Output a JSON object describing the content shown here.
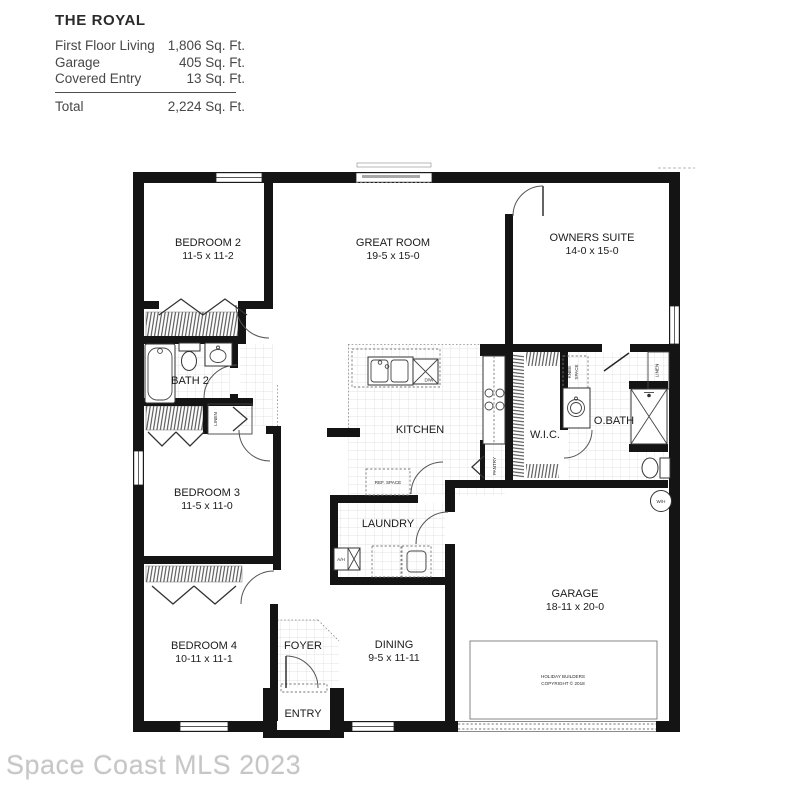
{
  "header": {
    "title": "THE ROYAL",
    "rows": [
      {
        "label": "First Floor Living",
        "value": "1,806 Sq. Ft."
      },
      {
        "label": "Garage",
        "value": "405 Sq. Ft."
      },
      {
        "label": "Covered Entry",
        "value": "13 Sq. Ft."
      }
    ],
    "total": {
      "label": "Total",
      "value": "2,224 Sq. Ft."
    }
  },
  "rooms": {
    "bedroom2": {
      "name": "BEDROOM 2",
      "dims": "11-5 x 11-2"
    },
    "great_room": {
      "name": "GREAT ROOM",
      "dims": "19-5 x 15-0"
    },
    "owners_suite": {
      "name": "OWNERS SUITE",
      "dims": "14-0 x 15-0"
    },
    "bedroom3": {
      "name": "BEDROOM 3",
      "dims": "11-5 x 11-0"
    },
    "bedroom4": {
      "name": "BEDROOM 4",
      "dims": "10-11 x 11-1"
    },
    "dining": {
      "name": "DINING",
      "dims": "9-5 x 11-11"
    },
    "garage": {
      "name": "GARAGE",
      "dims": "18-11 x 20-0"
    },
    "bath2": {
      "name": "BATH 2"
    },
    "kitchen": {
      "name": "KITCHEN"
    },
    "wic": {
      "name": "W.I.C."
    },
    "obath": {
      "name": "O.BATH"
    },
    "laundry": {
      "name": "LAUNDRY"
    },
    "foyer": {
      "name": "FOYER"
    },
    "entry": {
      "name": "ENTRY"
    }
  },
  "annotations": {
    "linen_hall": "LINEN",
    "linen_obath": "LINEN",
    "pantry": "PANTRY",
    "knee_line1": "KNEE",
    "knee_line2": "SPACE",
    "ref_space": "REF. SPACE",
    "dishwasher": "D/W",
    "air_handler": "A/H",
    "water_heater": "W/H"
  },
  "copyright": {
    "line1": "HOLIDAY BUILDERS",
    "line2": "COPYRIGHT © 2018"
  },
  "watermark": "Space Coast MLS 2023"
}
